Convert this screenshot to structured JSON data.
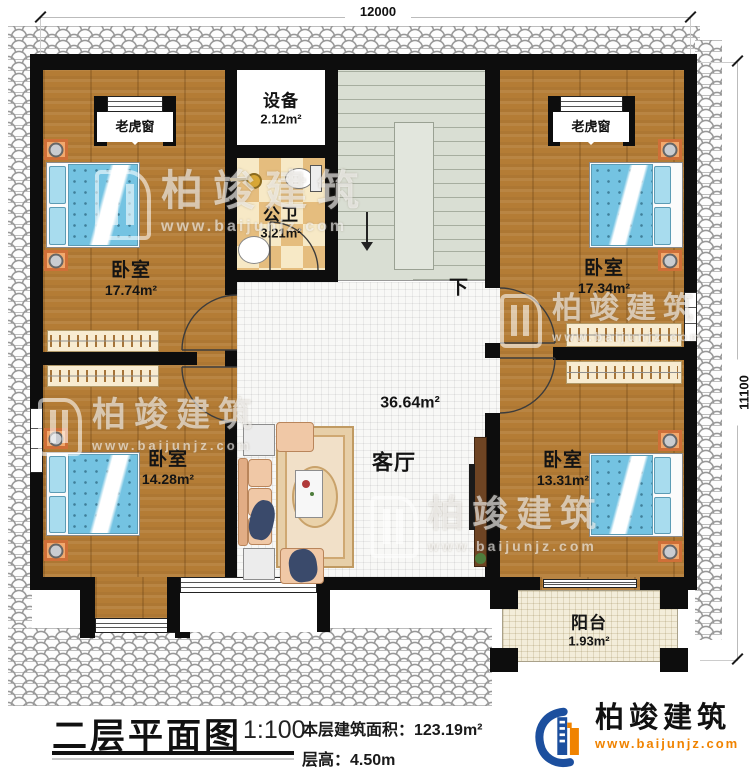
{
  "dimensions": {
    "top": "12000",
    "right": "11100"
  },
  "rooms": [
    {
      "id": "bedroom-top-left",
      "name": "卧室",
      "area": "17.74m²"
    },
    {
      "id": "bedroom-top-right",
      "name": "卧室",
      "area": "17.34m²"
    },
    {
      "id": "bedroom-bottom-left",
      "name": "卧室",
      "area": "14.28m²"
    },
    {
      "id": "bedroom-bottom-right",
      "name": "卧室",
      "area": "13.31m²"
    },
    {
      "id": "equipment",
      "name": "设备",
      "area": "2.12m²"
    },
    {
      "id": "bathroom",
      "name": "公卫",
      "area": "3.21m²"
    },
    {
      "id": "living-room",
      "name": "客厅",
      "area": "36.64m²"
    },
    {
      "id": "balcony",
      "name": "阳台",
      "area": "1.93m²"
    }
  ],
  "labels": {
    "dormer_window": "老虎窗",
    "stairs_down": "下"
  },
  "title_block": {
    "title": "二层平面图",
    "scale": "1:100",
    "floor_area": "本层建筑面积：123.19m²",
    "floor_height": "层高：4.50m"
  },
  "brand": {
    "name": "柏竣建筑",
    "url": "www.baijunjz.com",
    "logo_icon": "building-swoosh-logo",
    "url_color": "#f08300"
  },
  "watermark": {
    "name": "柏竣建筑",
    "url": "www.baijunjz.com"
  },
  "colors": {
    "wall": "#0d0d0d",
    "wood_floor": "#b47c35",
    "bed_blue": "#74c3e2",
    "stairs": "#d9ded3",
    "accent_orange": "#f08300",
    "logo_blue": "#1c4f9e"
  }
}
